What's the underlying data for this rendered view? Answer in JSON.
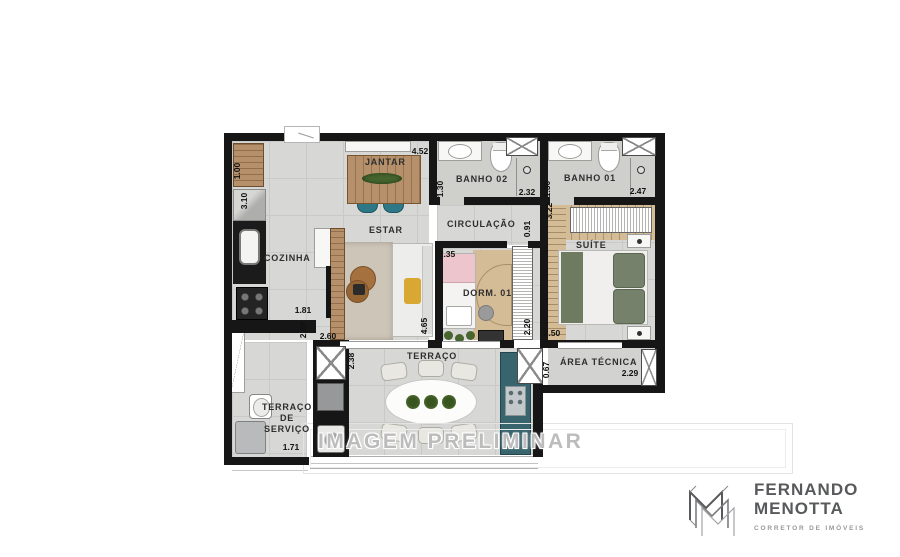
{
  "watermark": "IMAGEM PRELIMINAR",
  "logo": {
    "line1": "FERNANDO",
    "line2": "MENOTTA",
    "tagline": "CORRETOR DE IMÓVEIS"
  },
  "rooms": {
    "jantar": "JANTAR",
    "estar": "ESTAR",
    "cozinha": "COZINHA",
    "banho02": "BANHO 02",
    "banho01": "BANHO 01",
    "circulacao": "CIRCULAÇÃO",
    "suite": "SUÍTE",
    "dorm01": "DORM. 01",
    "terraco": "TERRAÇO",
    "area_tecnica": "ÁREA TÉCNICA",
    "servico_l1": "TERRAÇO",
    "servico_l2": "DE",
    "servico_l3": "SERVIÇO"
  },
  "dims": {
    "cozinha_bancada": "1.00",
    "cozinha_prof": "3.10",
    "jantar_larg": "4.52",
    "banho02_larg": "1.30",
    "banho02_comp": "2.32",
    "banho01_larg": "1.30",
    "banho01_comp": "2.47",
    "suite_comp": "3.22",
    "circulacao_larg": "0.91",
    "dorm01_larg": "2.35",
    "dorm01_comp": "2.20",
    "suite_larg": "2.50",
    "cozinha_larg": "1.81",
    "cozinha_comp": "2.89",
    "estar_larg": "2.60",
    "estar_comp": "4.65",
    "terraco_prof": "2.38",
    "servico_larg": "1.71",
    "area_tecnica_prof": "0.67",
    "area_tecnica_comp": "2.29"
  },
  "colors": {
    "wall": "#161616",
    "floor": "#d7d7d5",
    "floor_dark": "#cfcfcc",
    "wood": "#b5906a",
    "wood_light": "#d4bc97",
    "teal_chair": "#2d7787",
    "teal_counter": "#38646e",
    "rug": "#cdc5b8",
    "pink": "#ecc6cc",
    "green": "#6e7b60",
    "plant": "#47652f",
    "yellow": "#d9a832",
    "label": "#2e2e2e",
    "watermark": "#bcbcbc",
    "logo_gray": "#58595b"
  }
}
